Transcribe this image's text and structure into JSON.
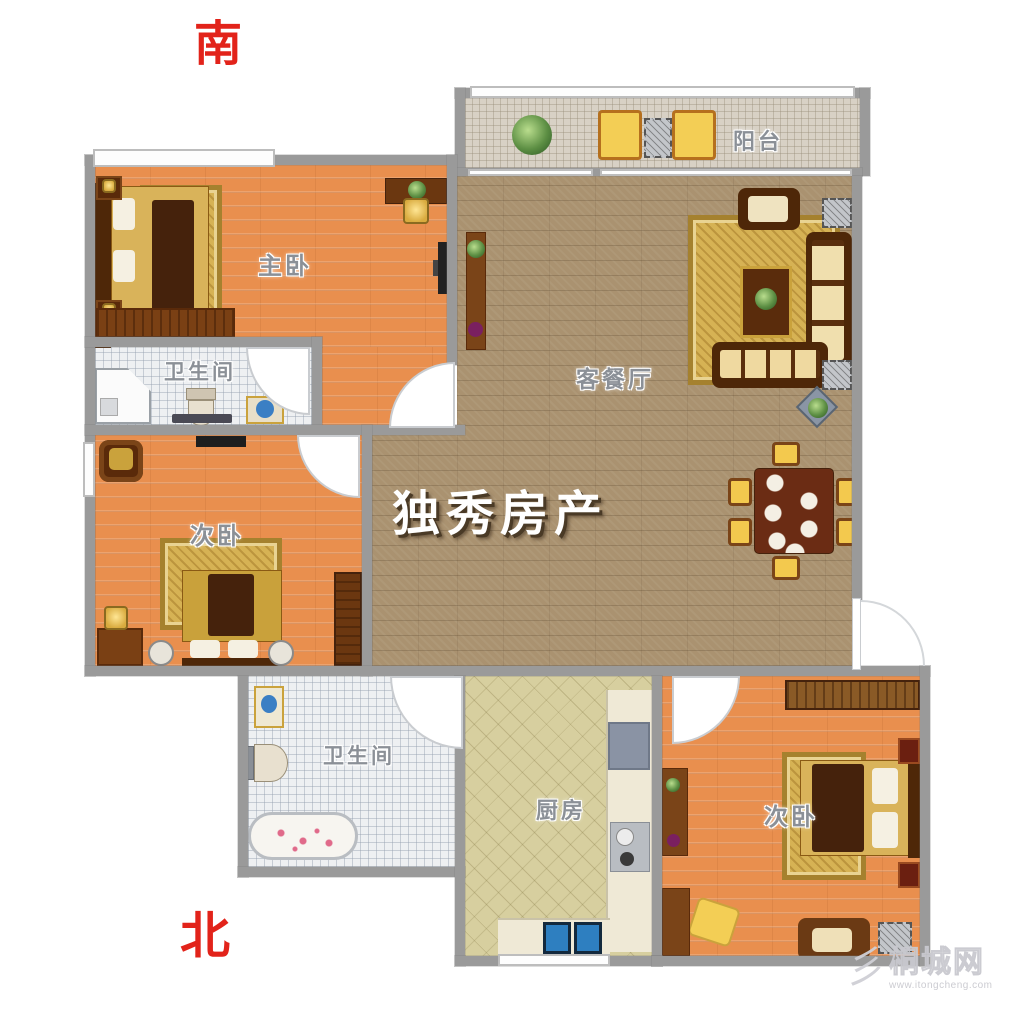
{
  "compass": {
    "south": "南",
    "north": "北"
  },
  "rooms": {
    "master_bedroom": {
      "label": "主卧"
    },
    "bathroom_upper": {
      "label": "卫生间"
    },
    "bedroom_left": {
      "label": "次卧"
    },
    "living_dining": {
      "label": "客餐厅"
    },
    "balcony": {
      "label": "阳台"
    },
    "bathroom_lower": {
      "label": "卫生间"
    },
    "kitchen": {
      "label": "厨房"
    },
    "bedroom_right": {
      "label": "次卧"
    }
  },
  "watermark": {
    "text": "独秀房产"
  },
  "site": {
    "logo_glyph": "彡",
    "name": "桐城网",
    "url": "www.itongcheng.com"
  },
  "colors": {
    "compass_red": "#e2231a",
    "wall_gray": "#9a9a9a",
    "wood_floor": "#e98f4e",
    "living_floor": "#aa9270",
    "kitchen_floor": "#d7cf9f",
    "tile_floor": "#eef0f2",
    "balcony_floor": "#d8d1c5",
    "watermark_white": "#ffffff"
  }
}
